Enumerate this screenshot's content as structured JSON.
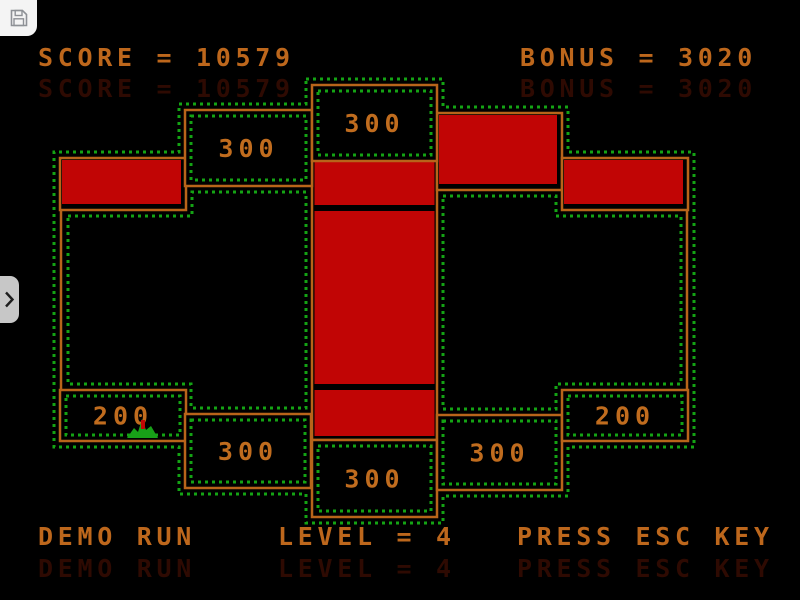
{
  "hud": {
    "score_text": "SCORE = 10579",
    "bonus_text": "BONUS = 3020",
    "demo_text": "DEMO RUN",
    "level_text": "LEVEL = 4",
    "esc_text": "PRESS ESC KEY",
    "score_value": 10579,
    "bonus_value": 3020,
    "level_value": 4
  },
  "chrome": {
    "save_button_icon": "floppy-disk",
    "side_toggle_icon": "chevron-right"
  },
  "colors": {
    "background": "#000000",
    "wall_orange": "#b8641a",
    "text_orange": "#bd671c",
    "label_orange": "#c06c1e",
    "block_red": "#c10505",
    "trace_green": "#14a314",
    "sprite_green": "#18a018",
    "ghost_red": "#2e0a02",
    "chrome_white": "#f4f4f4",
    "chrome_gray": "#c7c7c7",
    "icon_gray": "#8e9196"
  },
  "field": {
    "value_boxes": [
      {
        "x": 185,
        "y": 110,
        "w": 127,
        "h": 76,
        "label": "300"
      },
      {
        "x": 312,
        "y": 85,
        "w": 125,
        "h": 76,
        "label": "300"
      },
      {
        "x": 60,
        "y": 390,
        "w": 126,
        "h": 51,
        "label": "200"
      },
      {
        "x": 185,
        "y": 414,
        "w": 126,
        "h": 74,
        "label": "300"
      },
      {
        "x": 312,
        "y": 440,
        "w": 125,
        "h": 77,
        "label": "300"
      },
      {
        "x": 437,
        "y": 415,
        "w": 125,
        "h": 75,
        "label": "300"
      },
      {
        "x": 562,
        "y": 390,
        "w": 126,
        "h": 51,
        "label": "200"
      }
    ],
    "red_blocks": [
      {
        "x": 60,
        "y": 158,
        "w": 126,
        "h": 52
      },
      {
        "x": 437,
        "y": 113,
        "w": 125,
        "h": 77
      },
      {
        "x": 562,
        "y": 158,
        "w": 126,
        "h": 52
      }
    ],
    "column": {
      "x": 312,
      "y": 160,
      "w": 125,
      "h": 280,
      "segments": [
        {
          "y": 162,
          "h": 43
        },
        {
          "y": 211,
          "h": 173
        },
        {
          "y": 390,
          "h": 46
        }
      ]
    },
    "walls": [
      {
        "x1": 61,
        "y1": 209,
        "x2": 61,
        "y2": 391
      },
      {
        "x1": 687,
        "y1": 209,
        "x2": 687,
        "y2": 391
      }
    ],
    "dotted_loops": [
      [
        [
          306,
          79
        ],
        [
          443,
          79
        ],
        [
          443,
          107
        ],
        [
          568,
          107
        ],
        [
          568,
          152
        ],
        [
          694,
          152
        ],
        [
          694,
          447
        ],
        [
          568,
          447
        ],
        [
          568,
          496
        ],
        [
          443,
          496
        ],
        [
          443,
          523
        ],
        [
          306,
          523
        ],
        [
          306,
          494
        ],
        [
          179,
          494
        ],
        [
          179,
          447
        ],
        [
          54,
          447
        ],
        [
          54,
          152
        ],
        [
          179,
          152
        ],
        [
          179,
          104
        ],
        [
          306,
          104
        ]
      ],
      [
        [
          68,
          216
        ],
        [
          192,
          216
        ],
        [
          192,
          192
        ],
        [
          306,
          192
        ],
        [
          306,
          408
        ],
        [
          191,
          408
        ],
        [
          191,
          384
        ],
        [
          68,
          384
        ]
      ],
      [
        [
          443,
          196
        ],
        [
          556,
          196
        ],
        [
          556,
          216
        ],
        [
          681,
          216
        ],
        [
          681,
          384
        ],
        [
          556,
          384
        ],
        [
          556,
          409
        ],
        [
          443,
          409
        ]
      ]
    ],
    "sprite": {
      "points": "127,438 134,428 138,432 142,419 146,430 151,426 158,438",
      "dot": {
        "x": 141,
        "y": 420,
        "w": 4,
        "h": 9
      }
    }
  }
}
